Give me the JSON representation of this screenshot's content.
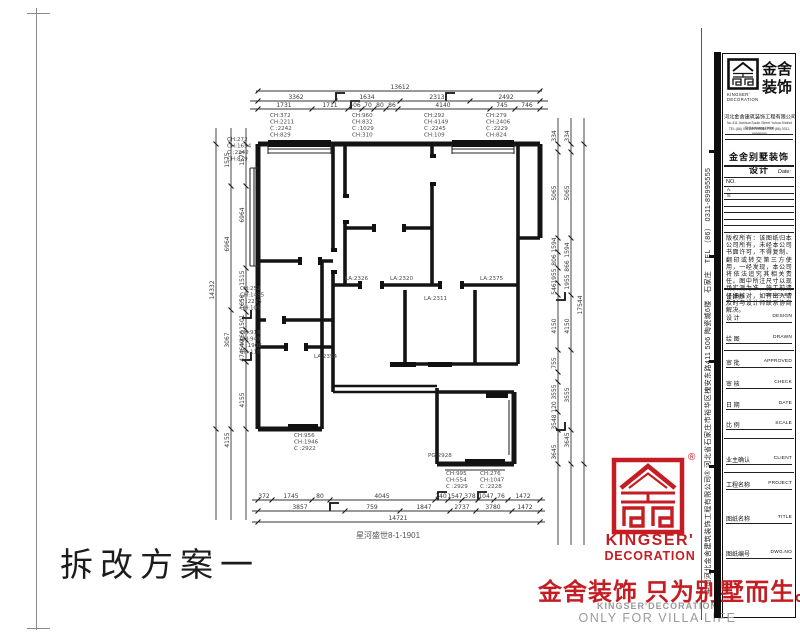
{
  "page": {
    "stamp": "拆改方案一"
  },
  "colors": {
    "brand_red": "#c41e24",
    "slogan_gray": "#9a9a9a",
    "line_black": "#141414"
  },
  "slogan": {
    "red_text": "金舍装饰 只为别墅而生。",
    "en_line1": "KINGSER'DECORATION",
    "en_line2": "ONLY FOR VILLA LIFE"
  },
  "corner_logo": {
    "registered": "®",
    "brand_line1": "KINGSER'",
    "brand_line2": "DECORATION"
  },
  "titleblock": {
    "brand_cn_1": "金舍",
    "brand_cn_2": "装饰",
    "logo_sub_1": "KINGSER'",
    "logo_sub_2": "DECORATION",
    "company_cn": "河北金舍建筑装饰工程有限公司",
    "company_en_1": "No.411 Jianhua South Street Yuhua District Shijiazhuang Hebei",
    "company_en_2": "TEL:(86) 0311-89995555   FAX:(86) 0311-89995555",
    "section_title": "金舍别墅装饰设计",
    "date_label": "Date:",
    "no_label": "NO.",
    "rev_a": "A.",
    "rev_s": "S:",
    "notice": "版权所有：该图纸归本公司所有，未经本公司书面许可，不得复制、翻印或转交第三方使用，一经发现，本公司将依法追究其相关责任。图中所注尺寸以现场实测为准，施工前请仔细核对，如有出入请及时与设计师联系协商解决。",
    "fields": [
      {
        "zh": "设计师",
        "en": "DESIGNED"
      },
      {
        "zh": "设 计",
        "en": "DESIGN"
      },
      {
        "zh": "绘 图",
        "en": "DRAWN"
      },
      {
        "zh": "审 批",
        "en": "APPROVED"
      },
      {
        "zh": "审 核",
        "en": "CHECK"
      },
      {
        "zh": "日 期",
        "en": "DATE"
      },
      {
        "zh": "比 例",
        "en": "SCALE"
      },
      {
        "zh": "业主确认",
        "en": "CLIENT"
      },
      {
        "zh": "工程名称",
        "en": "PROJECT"
      },
      {
        "zh": "图纸名称",
        "en": "TITLE"
      },
      {
        "zh": "图纸编号",
        "en": "DWG.NO"
      }
    ],
    "side_text": "中国河北金舍建筑装饰工程有限公司®  河北省石家庄市裕华区槐安东路411 506 陶瓷城6楼　石家庄　TEL （86） 0311-89995555"
  },
  "plan": {
    "caption": "星河盛世8-1-1901",
    "dim_h": [
      {
        "y": 91,
        "x1": 256,
        "x2": 542,
        "ticks": [
          258,
          540
        ],
        "nums": [
          {
            "x": 400,
            "t": "13612"
          }
        ]
      },
      {
        "y": 101,
        "x1": 250,
        "x2": 548,
        "ticks": [
          258,
          335,
          400,
          470,
          540
        ],
        "nums": [
          {
            "x": 296,
            "t": "3362"
          },
          {
            "x": 367,
            "t": "1634"
          },
          {
            "x": 437,
            "t": "2313"
          },
          {
            "x": 506,
            "t": "2492"
          }
        ]
      },
      {
        "y": 109,
        "x1": 250,
        "x2": 548,
        "ticks": [
          258,
          312,
          348,
          362,
          374,
          386,
          398,
          490,
          515,
          540
        ],
        "nums": [
          {
            "x": 284,
            "t": "1731"
          },
          {
            "x": 330,
            "t": "1711"
          },
          {
            "x": 355,
            "t": "406"
          },
          {
            "x": 368,
            "t": "70"
          },
          {
            "x": 380,
            "t": "80"
          },
          {
            "x": 392,
            "t": "86"
          },
          {
            "x": 443,
            "t": "4140"
          },
          {
            "x": 502,
            "t": "745"
          },
          {
            "x": 527,
            "t": "746"
          }
        ]
      },
      {
        "y": 500,
        "x1": 252,
        "x2": 545,
        "ticks": [
          258,
          272,
          312,
          330,
          435,
          448,
          462,
          478,
          494,
          508,
          540
        ],
        "nums": [
          {
            "x": 264,
            "t": "372"
          },
          {
            "x": 291,
            "t": "1745"
          },
          {
            "x": 320,
            "t": "80"
          },
          {
            "x": 382,
            "t": "4045"
          },
          {
            "x": 441,
            "t": "240"
          },
          {
            "x": 455,
            "t": "1547"
          },
          {
            "x": 470,
            "t": "378"
          },
          {
            "x": 486,
            "t": "1047"
          },
          {
            "x": 501,
            "t": "76"
          },
          {
            "x": 523,
            "t": "1472"
          }
        ]
      },
      {
        "y": 511,
        "x1": 252,
        "x2": 545,
        "ticks": [
          258,
          345,
          400,
          450,
          476,
          512,
          540
        ],
        "nums": [
          {
            "x": 300,
            "t": "3857"
          },
          {
            "x": 372,
            "t": "759"
          },
          {
            "x": 424,
            "t": "1847"
          },
          {
            "x": 462,
            "t": "2737"
          },
          {
            "x": 493,
            "t": "3780"
          },
          {
            "x": 525,
            "t": "1472"
          }
        ]
      },
      {
        "y": 522,
        "x1": 252,
        "x2": 545,
        "ticks": [
          258,
          540
        ],
        "nums": [
          {
            "x": 398,
            "t": "14721"
          }
        ]
      }
    ],
    "dim_v": [
      {
        "x": 216,
        "y1": 128,
        "y2": 520,
        "ticks": [
          144,
          429
        ],
        "nums": [
          {
            "y": 290,
            "t": "14332"
          }
        ]
      },
      {
        "x": 231,
        "y1": 128,
        "y2": 520,
        "ticks": [
          144,
          186,
          310,
          429
        ],
        "nums": [
          {
            "y": 160,
            "t": "1575"
          },
          {
            "y": 244,
            "t": "6964"
          },
          {
            "y": 340,
            "t": "3067"
          },
          {
            "y": 440,
            "t": "4155"
          }
        ]
      },
      {
        "x": 246,
        "y1": 128,
        "y2": 520,
        "ticks": [
          144,
          186,
          268,
          290,
          312,
          330,
          340,
          350,
          362,
          429
        ],
        "nums": [
          {
            "y": 158,
            "t": "1575"
          },
          {
            "y": 215,
            "t": "6964"
          },
          {
            "y": 278,
            "t": "1515"
          },
          {
            "y": 302,
            "t": "1656"
          },
          {
            "y": 322,
            "t": "1501"
          },
          {
            "y": 336,
            "t": "466"
          },
          {
            "y": 345,
            "t": "640"
          },
          {
            "y": 356,
            "t": "474"
          },
          {
            "y": 400,
            "t": "4155"
          }
        ]
      },
      {
        "x": 558,
        "y1": 118,
        "y2": 545,
        "ticks": [
          144,
          152,
          238,
          252,
          268,
          283,
          295,
          350,
          372,
          382,
          412,
          430,
          464
        ],
        "nums": [
          {
            "y": 136,
            "t": "334"
          },
          {
            "y": 193,
            "t": "5065"
          },
          {
            "y": 245,
            "t": "1594"
          },
          {
            "y": 260,
            "t": "806"
          },
          {
            "y": 276,
            "t": "1955"
          },
          {
            "y": 289,
            "t": "546"
          },
          {
            "y": 326,
            "t": "4150"
          },
          {
            "y": 363,
            "t": "755"
          },
          {
            "y": 392,
            "t": "3555"
          },
          {
            "y": 407,
            "t": "120"
          },
          {
            "y": 422,
            "t": "3548"
          },
          {
            "y": 452,
            "t": "3645"
          }
        ]
      },
      {
        "x": 571,
        "y1": 118,
        "y2": 545,
        "ticks": [
          144,
          152,
          238,
          295,
          350,
          430,
          464
        ],
        "nums": [
          {
            "y": 136,
            "t": "334"
          },
          {
            "y": 193,
            "t": "5065"
          },
          {
            "y": 250,
            "t": "1594"
          },
          {
            "y": 266,
            "t": "866"
          },
          {
            "y": 282,
            "t": "1955"
          },
          {
            "y": 326,
            "t": "4150"
          },
          {
            "y": 395,
            "t": "3555"
          },
          {
            "y": 440,
            "t": "3645"
          }
        ]
      },
      {
        "x": 584,
        "y1": 118,
        "y2": 545,
        "ticks": [
          144,
          464
        ],
        "nums": [
          {
            "y": 305,
            "t": "17544"
          }
        ]
      }
    ],
    "ch_blocks": [
      {
        "x": 270,
        "y": 117,
        "lines": [
          "CH:372",
          "CH:2211",
          "C :2242",
          "CH:829"
        ]
      },
      {
        "x": 352,
        "y": 117,
        "lines": [
          "CH:960",
          "CH:832",
          "C :1029",
          "CH:310"
        ]
      },
      {
        "x": 424,
        "y": 117,
        "lines": [
          "CH:292",
          "CH:4149",
          "C :2245",
          "CH:109"
        ]
      },
      {
        "x": 486,
        "y": 117,
        "lines": [
          "CH:279",
          "CH:2406",
          "C :2229",
          "CH:824"
        ]
      },
      {
        "x": 227,
        "y": 141,
        "lines": [
          "CH:272",
          "CH:1654",
          "C :2242",
          "CH:829"
        ]
      },
      {
        "x": 240,
        "y": 290,
        "lines": [
          "CH:252",
          "CH:1455",
          "C :2225",
          "CH:105"
        ]
      },
      {
        "x": 240,
        "y": 334,
        "lines": [
          "CH:916",
          "CH:949",
          "C :1908",
          "CH:110"
        ]
      },
      {
        "x": 294,
        "y": 437,
        "lines": [
          "CH:956",
          "CH:1946",
          "C :2922"
        ]
      },
      {
        "x": 446,
        "y": 475,
        "lines": [
          "CH:995",
          "CH:554",
          "C :2929"
        ]
      },
      {
        "x": 480,
        "y": 475,
        "lines": [
          "CH:276",
          "CH:1047",
          "C :2228"
        ]
      }
    ],
    "room_labels": [
      {
        "x": 345,
        "y": 280,
        "t": "LA:2326"
      },
      {
        "x": 390,
        "y": 280,
        "t": "LA:2320"
      },
      {
        "x": 480,
        "y": 280,
        "t": "LA:2375"
      },
      {
        "x": 424,
        "y": 300,
        "t": "LA:2311"
      },
      {
        "x": 314,
        "y": 358,
        "t": "LA:2354"
      },
      {
        "x": 428,
        "y": 457,
        "t": "PG:2928"
      }
    ]
  }
}
